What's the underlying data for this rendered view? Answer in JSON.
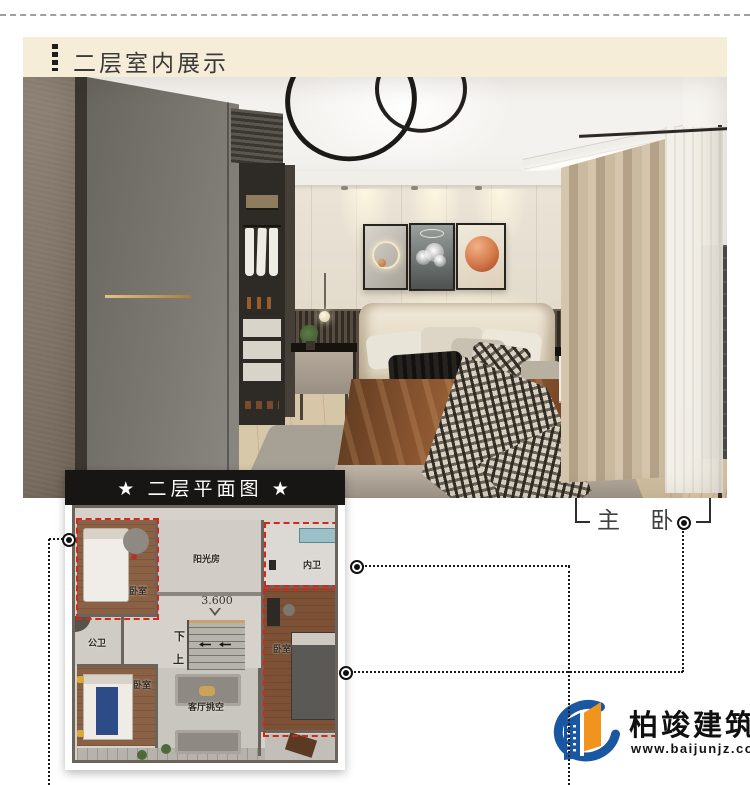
{
  "header": {
    "title": "二层室内展示"
  },
  "floorplan": {
    "title": "★ 二层平面图 ★",
    "rooms": {
      "bedroom_tl": "卧室",
      "sunroom": "阳光房",
      "bath_inner": "内卫",
      "bath_public": "公卫",
      "bedroom_right": "卧室",
      "bedroom_bl": "卧室",
      "living_void": "客厅挑空",
      "elevation": "3.600",
      "stairs_down": "下",
      "stairs_up": "上"
    }
  },
  "annotation": {
    "master_label": "主 卧"
  },
  "logo": {
    "name": "柏竣建筑",
    "url": "www.baijunjz.com"
  },
  "palette": {
    "header_bg": "#f5edd7",
    "plan_titlebar_bg": "#171614",
    "highlight_red": "#d3271c",
    "connector_black": "#1a1a1a",
    "logo_blue": "#1a57a3",
    "logo_orange": "#f0941d"
  }
}
